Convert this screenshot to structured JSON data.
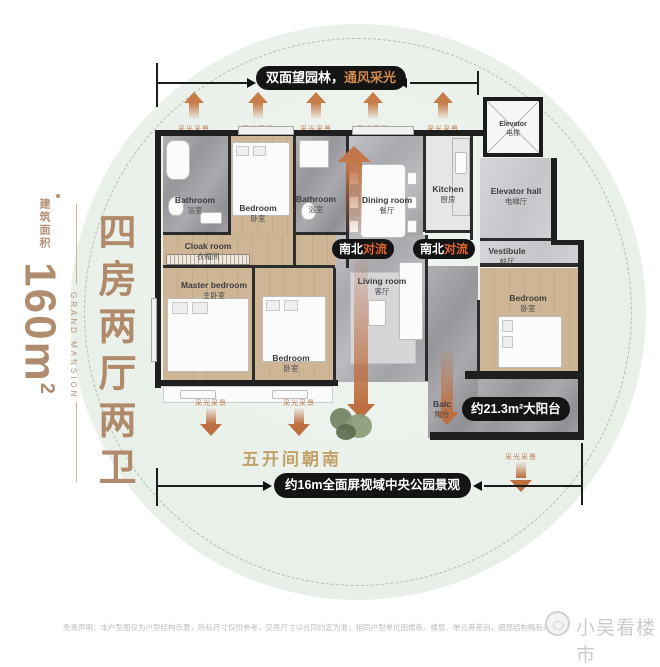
{
  "banner": {
    "white": "双面望园林，",
    "gold": "通风采光"
  },
  "left": {
    "area_label": "建筑面积",
    "area_value": "160m",
    "area_unit_sup": "2",
    "brand": "GRAND MANSION",
    "title": "四房两厅两卫"
  },
  "labels": {
    "daylight": "采光采景",
    "convection_white": "南北",
    "convection_accent": "对流",
    "south": "五开间朝南",
    "view_badge": "约16m全面屏视域中央公园景观",
    "balcony_badge": "约21.3m²大阳台"
  },
  "rooms": {
    "bathroom1": {
      "en": "Bathroom",
      "cn": "浴室"
    },
    "bedroom_top": {
      "en": "Bedroom",
      "cn": "卧室"
    },
    "bathroom2": {
      "en": "Bathroom",
      "cn": "浴室"
    },
    "dining": {
      "en": "Dining room",
      "cn": "餐厅"
    },
    "kitchen": {
      "en": "Kitchen",
      "cn": "厨房"
    },
    "elevator": {
      "en": "Elevator",
      "cn": "电梯"
    },
    "elevator_hall": {
      "en": "Elevator hall",
      "cn": "电梯厅"
    },
    "vestibule": {
      "en": "Vestibule",
      "cn": "前厅"
    },
    "cloak": {
      "en": "Cloak room",
      "cn": "衣帽间"
    },
    "master": {
      "en": "Master bedroom",
      "cn": "主卧室"
    },
    "bedroom2": {
      "en": "Bedroom",
      "cn": "卧室"
    },
    "living": {
      "en": "Living room",
      "cn": "客厅"
    },
    "bedroom3": {
      "en": "Bedroom",
      "cn": "卧室"
    },
    "balcony": {
      "en": "Balc",
      "cn": "阳台"
    }
  },
  "footer": {
    "disclaimer": "免责声明：本户型图仅为户型结构示意，所标尺寸仅供参考，交房尺寸以合同约定为准；相同户型单位因楼栋、楼层、单元等差别，细部结构略有差异",
    "watermark": "小吴看楼市"
  },
  "colors": {
    "accent_tan": "#b08c6e",
    "gold": "#cf8b4e",
    "arrow_orange": "#c3764a",
    "pill_black": "#141414",
    "circle_green": "#eaf1ea",
    "convection_accent": "#e0642e"
  }
}
